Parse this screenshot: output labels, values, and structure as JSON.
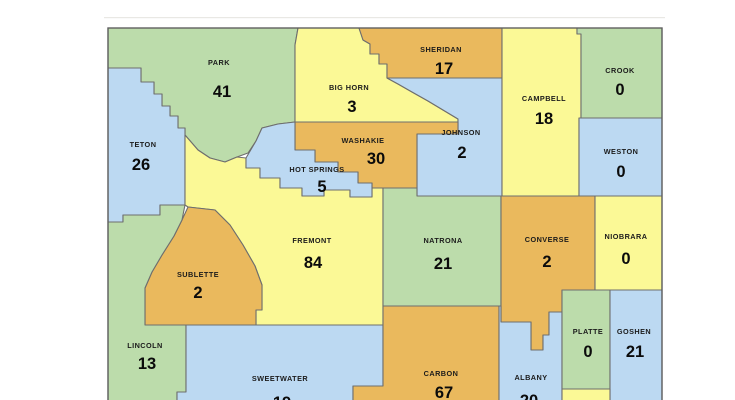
{
  "map": {
    "region_label": "Wyoming counties map with values",
    "background": "#ffffff",
    "stroke_color": "#6e6e6e",
    "state_border_color": "#606060",
    "divider_line_color": "#e9e8e4",
    "palette": {
      "green": "#bcdcab",
      "yellow": "#fbf996",
      "orange": "#eab95d",
      "blue": "#bcd9f2"
    },
    "frame": {
      "x": 108,
      "y": 28,
      "x2": 662,
      "y2": 402
    },
    "divider": {
      "x": 104,
      "y": 17,
      "x2": 665
    },
    "counties": [
      {
        "id": "park",
        "name": "PARK",
        "value": "41",
        "color": "green",
        "points": "108,28 298,28 295,45 295,122 278,124 262,128 256,141 248,153 237,157 225,162 210,158 198,150 185,135 185,128 178,128 178,116 170,116 170,106 162,106 162,94 154,94 154,82 141,82 141,68 108,68",
        "nx": 219,
        "ny": 65,
        "vx": 222,
        "vy": 97
      },
      {
        "id": "teton",
        "name": "TETON",
        "value": "26",
        "color": "blue",
        "points": "108,68 141,68 141,82 154,82 154,94 162,94 162,106 170,106 170,116 178,116 178,128 185,128 185,205 160,205 160,215 123,215 123,222 108,222",
        "nx": 143,
        "ny": 147,
        "vx": 141,
        "vy": 170
      },
      {
        "id": "bighorn",
        "name": "BIG HORN",
        "value": "3",
        "color": "yellow",
        "points": "298,28 359,28 363,40 370,44 370,54 379,54 379,64 387,64 387,78 398,84 412,92 428,101 443,110 458,119 458,122 295,122 295,45",
        "nx": 349,
        "ny": 90,
        "vx": 352,
        "vy": 112
      },
      {
        "id": "sheridan",
        "name": "SHERIDAN",
        "value": "17",
        "color": "orange",
        "points": "359,28 502,28 502,78 387,78 387,64 379,64 379,54 370,54 370,44 363,40",
        "nx": 441,
        "ny": 52,
        "vx": 444,
        "vy": 74
      },
      {
        "id": "johnson",
        "name": "JOHNSON",
        "value": "2",
        "color": "blue",
        "points": "387,78 502,78 502,196 417,196 417,134 458,134 458,119 443,110 428,101 412,92 398,84",
        "nx": 461,
        "ny": 135,
        "vx": 462,
        "vy": 158
      },
      {
        "id": "washakie",
        "name": "WASHAKIE",
        "value": "30",
        "color": "orange",
        "points": "295,122 458,122 458,134 417,134 417,188 372,188 372,183 358,183 358,172 338,172 338,162 315,162 315,150 295,150",
        "nx": 363,
        "ny": 143,
        "vx": 376,
        "vy": 164
      },
      {
        "id": "fremont",
        "name": "FREMONT",
        "value": "84",
        "color": "yellow",
        "points": "185,135 198,150 210,158 225,162 237,157 246,158 246,168 260,168 260,178 280,178 280,188 302,188 302,196 324,196 324,190 350,190 350,197 372,197 372,188 383,188 383,325 256,325 256,310 262,310 262,285 255,266 243,245 230,225 215,210 188,207 185,205",
        "nx": 312,
        "ny": 243,
        "vx": 313,
        "vy": 268
      },
      {
        "id": "hotsprings",
        "name": "HOT SPRINGS",
        "value": "5",
        "color": "blue",
        "points": "262,128 278,124 295,122 295,150 315,150 315,162 338,162 338,172 358,172 358,183 372,183 372,197 350,197 350,190 324,190 324,196 302,196 302,188 280,188 280,178 260,178 260,168 246,168 246,158 256,141",
        "nx": 317,
        "ny": 172,
        "vx": 322,
        "vy": 192
      },
      {
        "id": "campbell",
        "name": "CAMPBELL",
        "value": "18",
        "color": "yellow",
        "points": "502,28 577,28 577,34 581,34 581,118 579,118 579,196 502,196",
        "nx": 544,
        "ny": 101,
        "vx": 544,
        "vy": 124
      },
      {
        "id": "crook",
        "name": "CROOK",
        "value": "0",
        "color": "green",
        "points": "581,28 662,28 662,118 581,118 581,34 577,34 577,28",
        "nx": 620,
        "ny": 73,
        "vx": 620,
        "vy": 95
      },
      {
        "id": "weston",
        "name": "WESTON",
        "value": "0",
        "color": "blue",
        "points": "579,118 662,118 662,196 579,196",
        "nx": 621,
        "ny": 154,
        "vx": 621,
        "vy": 177
      },
      {
        "id": "sublette",
        "name": "SUBLETTE",
        "value": "2",
        "color": "orange",
        "points": "188,207 215,210 230,225 243,245 255,266 262,285 262,310 256,310 256,325 145,325 145,288 152,272 162,255 174,236 182,220",
        "nx": 198,
        "ny": 277,
        "vx": 198,
        "vy": 298
      },
      {
        "id": "lincoln",
        "name": "LINCOLN",
        "value": "13",
        "color": "green",
        "points": "108,222 123,222 123,215 160,215 160,205 185,205 182,220 174,236 162,255 152,272 145,288 145,325 186,325 186,392 177,392 177,401 108,401",
        "nx": 145,
        "ny": 348,
        "vx": 147,
        "vy": 369
      },
      {
        "id": "sweetwater",
        "name": "SWEETWATER",
        "value": "19",
        "color": "blue",
        "points": "186,325 383,325 383,386 353,386 353,401 177,401 177,392 186,392",
        "nx": 280,
        "ny": 381,
        "vx": 282,
        "vy": 408
      },
      {
        "id": "natrona",
        "name": "NATRONA",
        "value": "21",
        "color": "green",
        "points": "383,188 417,188 417,196 501,196 501,306 383,306",
        "nx": 443,
        "ny": 243,
        "vx": 443,
        "vy": 269
      },
      {
        "id": "converse",
        "name": "CONVERSE",
        "value": "2",
        "color": "orange",
        "points": "501,196 595,196 595,290 562,290 562,312 549,312 549,335 543,335 543,350 531,350 531,322 501,322",
        "nx": 547,
        "ny": 242,
        "vx": 547,
        "vy": 267
      },
      {
        "id": "niobrara",
        "name": "NIOBRARA",
        "value": "0",
        "color": "yellow",
        "points": "595,196 662,196 662,290 595,290",
        "nx": 626,
        "ny": 239,
        "vx": 626,
        "vy": 264
      },
      {
        "id": "carbon",
        "name": "CARBON",
        "value": "67",
        "color": "orange",
        "points": "383,306 499,306 499,401 353,401 353,386 383,386",
        "nx": 441,
        "ny": 376,
        "vx": 444,
        "vy": 398
      },
      {
        "id": "albany",
        "name": "ALBANY",
        "value": "20",
        "color": "blue",
        "points": "499,306 501,306 501,322 531,322 531,350 543,350 543,335 549,335 549,312 562,312 562,401 499,401",
        "nx": 531,
        "ny": 380,
        "vx": 529,
        "vy": 406
      },
      {
        "id": "platte",
        "name": "PLATTE",
        "value": "0",
        "color": "green",
        "points": "562,290 610,290 610,389 562,389",
        "nx": 588,
        "ny": 334,
        "vx": 588,
        "vy": 357
      },
      {
        "id": "goshen",
        "name": "GOSHEN",
        "value": "21",
        "color": "blue",
        "points": "610,290 662,290 662,401 610,401",
        "nx": 634,
        "ny": 334,
        "vx": 635,
        "vy": 357
      },
      {
        "id": "laramie",
        "name": "",
        "value": "",
        "color": "yellow",
        "points": "562,389 610,389 610,401 562,401",
        "nx": 0,
        "ny": 0,
        "vx": 0,
        "vy": 0
      }
    ]
  }
}
